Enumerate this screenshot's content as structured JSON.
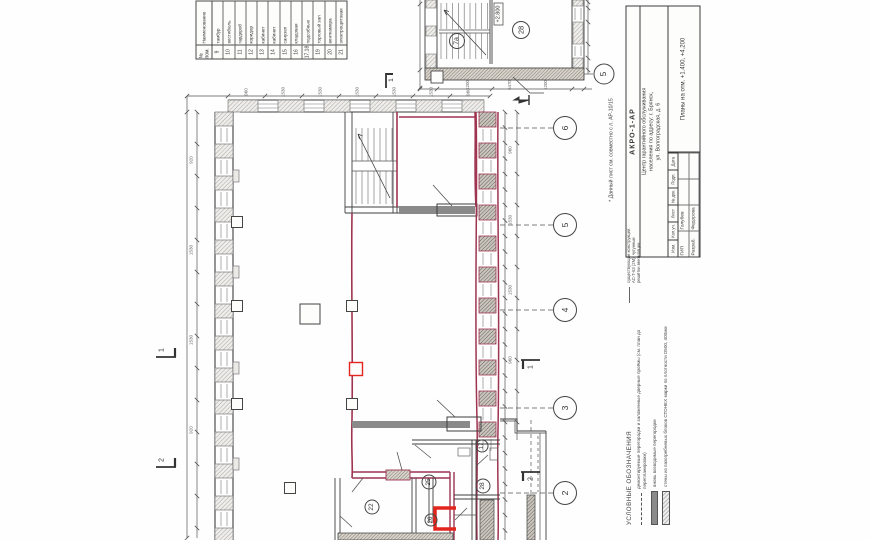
{
  "colors": {
    "ink": "#3c3c3c",
    "red_markup": "#9e3450",
    "red_bright": "#e3261d",
    "gray_fill": "#8a8a8a"
  },
  "explication": {
    "col_no": "№ пом.",
    "col_name": "Наименование",
    "rows": [
      {
        "no": "9",
        "name": "тамбур"
      },
      {
        "no": "10",
        "name": "вестибюль"
      },
      {
        "no": "11",
        "name": "гардероб"
      },
      {
        "no": "12",
        "name": "коридор"
      },
      {
        "no": "13",
        "name": "кабинет"
      },
      {
        "no": "14",
        "name": "кабинет"
      },
      {
        "no": "15",
        "name": "санузел"
      },
      {
        "no": "16",
        "name": "кладовая"
      },
      {
        "no": "17,18",
        "name": "подсобные"
      },
      {
        "no": "19",
        "name": "торговый зал"
      },
      {
        "no": "20",
        "name": "венткамера"
      },
      {
        "no": "21",
        "name": "электрощитовая"
      }
    ]
  },
  "upper_plan": {
    "stair_room": "7а",
    "room": "28",
    "elevation": "+2.800",
    "grid": "5"
  },
  "axes": {
    "labels": [
      "6",
      "5",
      "4",
      "3",
      "2"
    ]
  },
  "sections": {
    "s1": "1",
    "s2": "2",
    "top": "1"
  },
  "rooms": {
    "r17": "17",
    "r25": "25",
    "r28": "28",
    "r22": "22",
    "r26": "26"
  },
  "note": "* Данный лист см. совместно с л. АР-10/15",
  "stamp": {
    "code": "АКРО-1-АР",
    "object_line1": "Центр гарантийного обслуживания",
    "object_line2": "населения по адресу: г. Брянск,",
    "object_line3": "ул. Волгоградская, д. 6",
    "cols": [
      "Изм.",
      "Кол.уч.",
      "Лист",
      "№ док.",
      "Подп.",
      "Дата"
    ],
    "rows": [
      {
        "role": "ГИП",
        "name": "Голубев"
      },
      {
        "role": "Разраб.",
        "name": "Федорова"
      }
    ],
    "sheet_title": "Планы на отм. +1.400, +4.200"
  },
  "legend": {
    "title": "УСЛОВНЫЕ ОБОЗНАЧЕНИЯ",
    "items": [
      {
        "text": "демонтируемые перегородки и заложенные дверные проёмы (см. план до перепланировки)"
      },
      {
        "text": "вновь возводимые перегородки"
      },
      {
        "text": "стены из пазогребневых блоков СТОНЕХ марки по плотности D500, 400мм"
      },
      {
        "text": "существующие конструкции: АС-Т-63 (2М), чугунные решётки вентиляции"
      }
    ]
  },
  "dims": {
    "top": [
      "960",
      "1530",
      "1530",
      "1530",
      "1530",
      "1530",
      "960"
    ],
    "left": [
      "920",
      "1530",
      "1530",
      "920"
    ],
    "right": [
      "960",
      "1530",
      "1530",
      "960"
    ],
    "frag": [
      "1200",
      "5470",
      "1200"
    ]
  }
}
